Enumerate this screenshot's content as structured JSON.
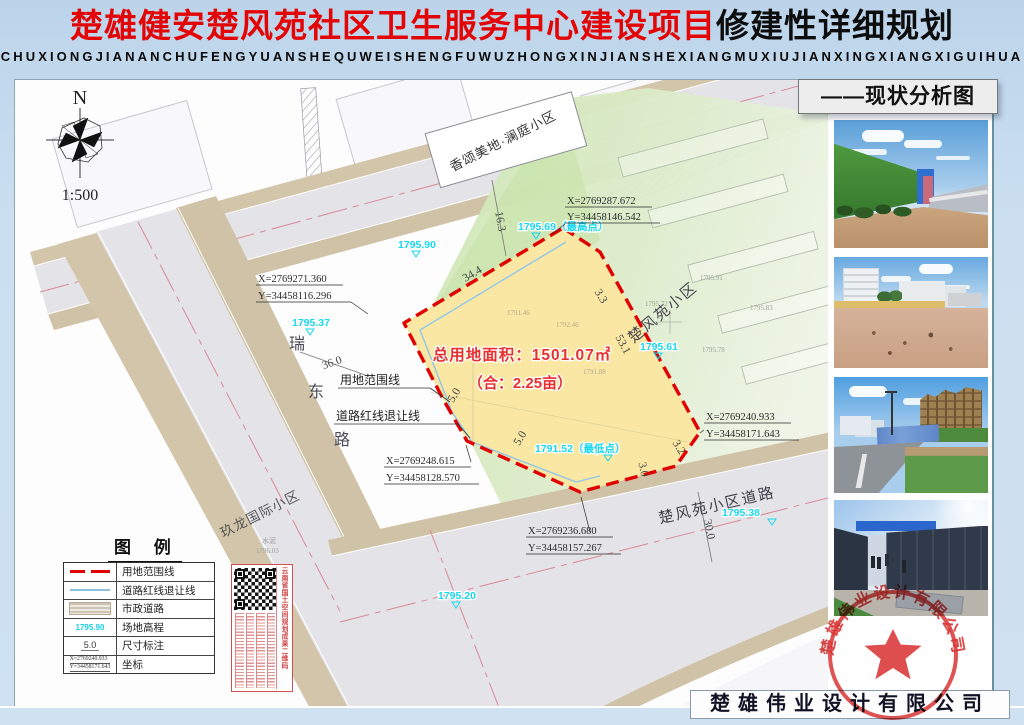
{
  "title": {
    "main_red": "楚雄健安楚风苑社区卫生服务中心建设项目",
    "main_black": "修建性详细规划",
    "pinyin": "CHUXIONGJIANANCHUFENGYUANSHEQUWEISHENGFUWUZHONGXINJIANSHEXIANGMUXIUJIANXINGXIANGXIGUIHUA"
  },
  "drawing_label": "——现状分析图",
  "north": {
    "letter": "N",
    "scale": "1:500"
  },
  "parcel": {
    "area_line1": "总用地面积：1501.07㎡",
    "area_line2": "（合：2.25亩）"
  },
  "elevations": {
    "e1795_90": "1795.90",
    "high": "1795.69（最高点）",
    "e1795_37": "1795.37",
    "e1795_61": "1795.61",
    "low": "1791.52（最低点）",
    "e1795_38": "1795.38",
    "e1795_20": "1795.20"
  },
  "spot_elevations": {
    "s1": "1791.46",
    "s2": "1792.46",
    "s3": "1792.06",
    "s4": "1791.88",
    "s5": "1795.91",
    "s6": "1795.72",
    "s7": "1795.83",
    "s8": "1795.78",
    "s9": "1796.03",
    "surface": "水泥"
  },
  "dimensions": {
    "d16_3": "16.3",
    "d34_4": "34.4",
    "d3_3": "3.3",
    "d53_1": "53.1",
    "d3_2": "3.2",
    "d3_0": "3.0",
    "d5_0a": "5.0",
    "d5_0b": "5.0",
    "d36_0": "36.0",
    "d30_0": "30.0"
  },
  "coords": {
    "c1x": "X=2769287.672",
    "c1y": "Y=34458146.542",
    "c2x": "X=2769271.360",
    "c2y": "Y=34458116.296",
    "c3x": "X=2769240.933",
    "c3y": "Y=34458171.643",
    "c4x": "X=2769248.615",
    "c4y": "Y=34458128.570",
    "c5x": "X=2769236.680",
    "c5y": "Y=34458157.267"
  },
  "places": {
    "xiangsong": "香颂美地·澜庭小区",
    "chufengyuan": "楚风苑小区",
    "jiulong": "玖龙国际小区",
    "chufengyuan_road": "楚风苑小区道路",
    "ruidong": [
      "瑞",
      "东",
      "路"
    ]
  },
  "line_labels": {
    "yongdi": "用地范围线",
    "daolu": "道路红线退让线"
  },
  "legend": {
    "title": "图 例",
    "rows": [
      {
        "label": "用地范围线"
      },
      {
        "label": "道路红线退让线"
      },
      {
        "label": "市政道路"
      },
      {
        "label": "场地高程",
        "symbol": "1795.90"
      },
      {
        "label": "尺寸标注",
        "symbol": "5.0"
      },
      {
        "label": "坐标",
        "symbol_x": "X=2769240.933",
        "symbol_y": "Y=34458171.643"
      }
    ]
  },
  "qr": {
    "caption": "云南省国土空间规划成果二维码"
  },
  "stamp": {
    "company": "楚雄伟业设计有限公司"
  },
  "footer": {
    "company": "楚雄伟业设计有限公司"
  }
}
